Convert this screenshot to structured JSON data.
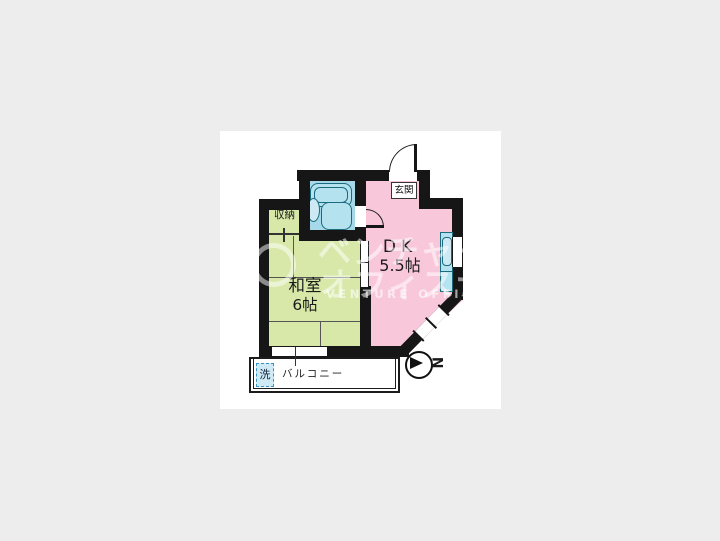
{
  "floorplan": {
    "rooms": {
      "dk": {
        "name": "DK",
        "size": "5.5帖"
      },
      "washitsu": {
        "name": "和室",
        "size": "6帖"
      },
      "genkan": {
        "label": "玄関"
      },
      "shuno": {
        "label": "収納"
      },
      "balcony": {
        "label": "バルコニー"
      },
      "laundry": {
        "label": "洗"
      }
    },
    "compass": {
      "letter": "N"
    },
    "colors": {
      "background": "#ededed",
      "card": "#ffffff",
      "wall": "#161616",
      "dk_pink": "#f8c8da",
      "tatami_green": "#d7e8a9",
      "bath_blue": "#a5d9e9",
      "fixture_fill": "#b5e2ef",
      "fixture_inner": "#cdeaf4",
      "fixture_border": "#1a6b7d",
      "laundry_fill": "#cfeaf7",
      "laundry_border": "#3593c5"
    }
  },
  "watermark": {
    "line1": "ベンチャー",
    "line2": "オフィスナビ",
    "line3": "VENTURE OFFICE NAVI"
  }
}
